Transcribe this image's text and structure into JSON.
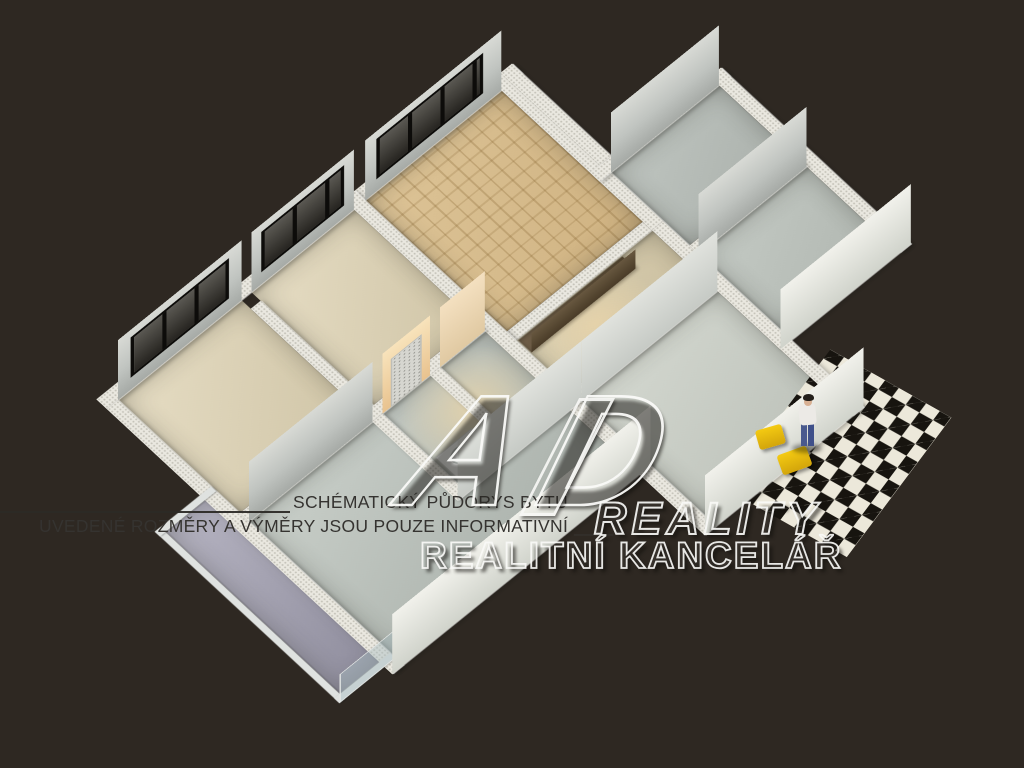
{
  "caption": {
    "line1": "SCHÉMATICKÝ PŮDORYS BYTU",
    "line2": "UVEDENÉ ROZMĚRY A VÝMĚRY JSOU POUZE INFORMATIVNÍ",
    "line2_suffix": "____"
  },
  "watermark": {
    "monogram": "AD",
    "word1": "REALITY",
    "word2": "REALITNÍ KANCELÁŘ"
  },
  "scene": {
    "type": "3d-apartment-floorplan-render",
    "view": "isometric-top-down",
    "background_color": "#2e2822",
    "wall_top_color": "#eae8e0",
    "window_glass_color": "#34322d",
    "checker_dark": "#17140f",
    "checker_light": "#ece8da",
    "chair_yellow": "#f0c011",
    "caption_text_color": "#353330",
    "watermark_stroke_color": "#f8f8f6",
    "rooms": [
      {
        "name": "bedroom-top",
        "floor": "parquet",
        "features": [
          "dark-3-pane-window"
        ]
      },
      {
        "name": "bedroom-middle",
        "floor": "beige-carpet",
        "features": [
          "dark-3-pane-window"
        ]
      },
      {
        "name": "bedroom-left",
        "floor": "beige-carpet",
        "features": [
          "dark-3-pane-window"
        ]
      },
      {
        "name": "living-room",
        "floor": "gray-green",
        "features": [
          "balcony-glass-door"
        ]
      },
      {
        "name": "bathroom",
        "floor": "warm-tile",
        "features": [
          "vanity",
          "round-sink",
          "mirror",
          "warm-ceiling-light"
        ]
      },
      {
        "name": "wc",
        "floor": "warm-tile",
        "features": [
          "toilet"
        ]
      },
      {
        "name": "hallway",
        "floor": "beige",
        "features": [
          "dark-kitchen-counter"
        ]
      },
      {
        "name": "entry-hall",
        "floor": "pale-gray",
        "features": [
          "white-panel-door",
          "dotted-door"
        ]
      },
      {
        "name": "right-room-upper",
        "floor": "gray",
        "features": [
          "dotted-door"
        ]
      },
      {
        "name": "right-room-lower",
        "floor": "gray",
        "features": [
          "dotted-door"
        ]
      },
      {
        "name": "balcony",
        "floor": "lavender-gray",
        "features": [
          "glass-railing"
        ]
      },
      {
        "name": "stair-landing",
        "floor": "black-white-checkerboard",
        "features": [
          "person-figure",
          "yellow-chair",
          "yellow-chair"
        ]
      }
    ]
  }
}
